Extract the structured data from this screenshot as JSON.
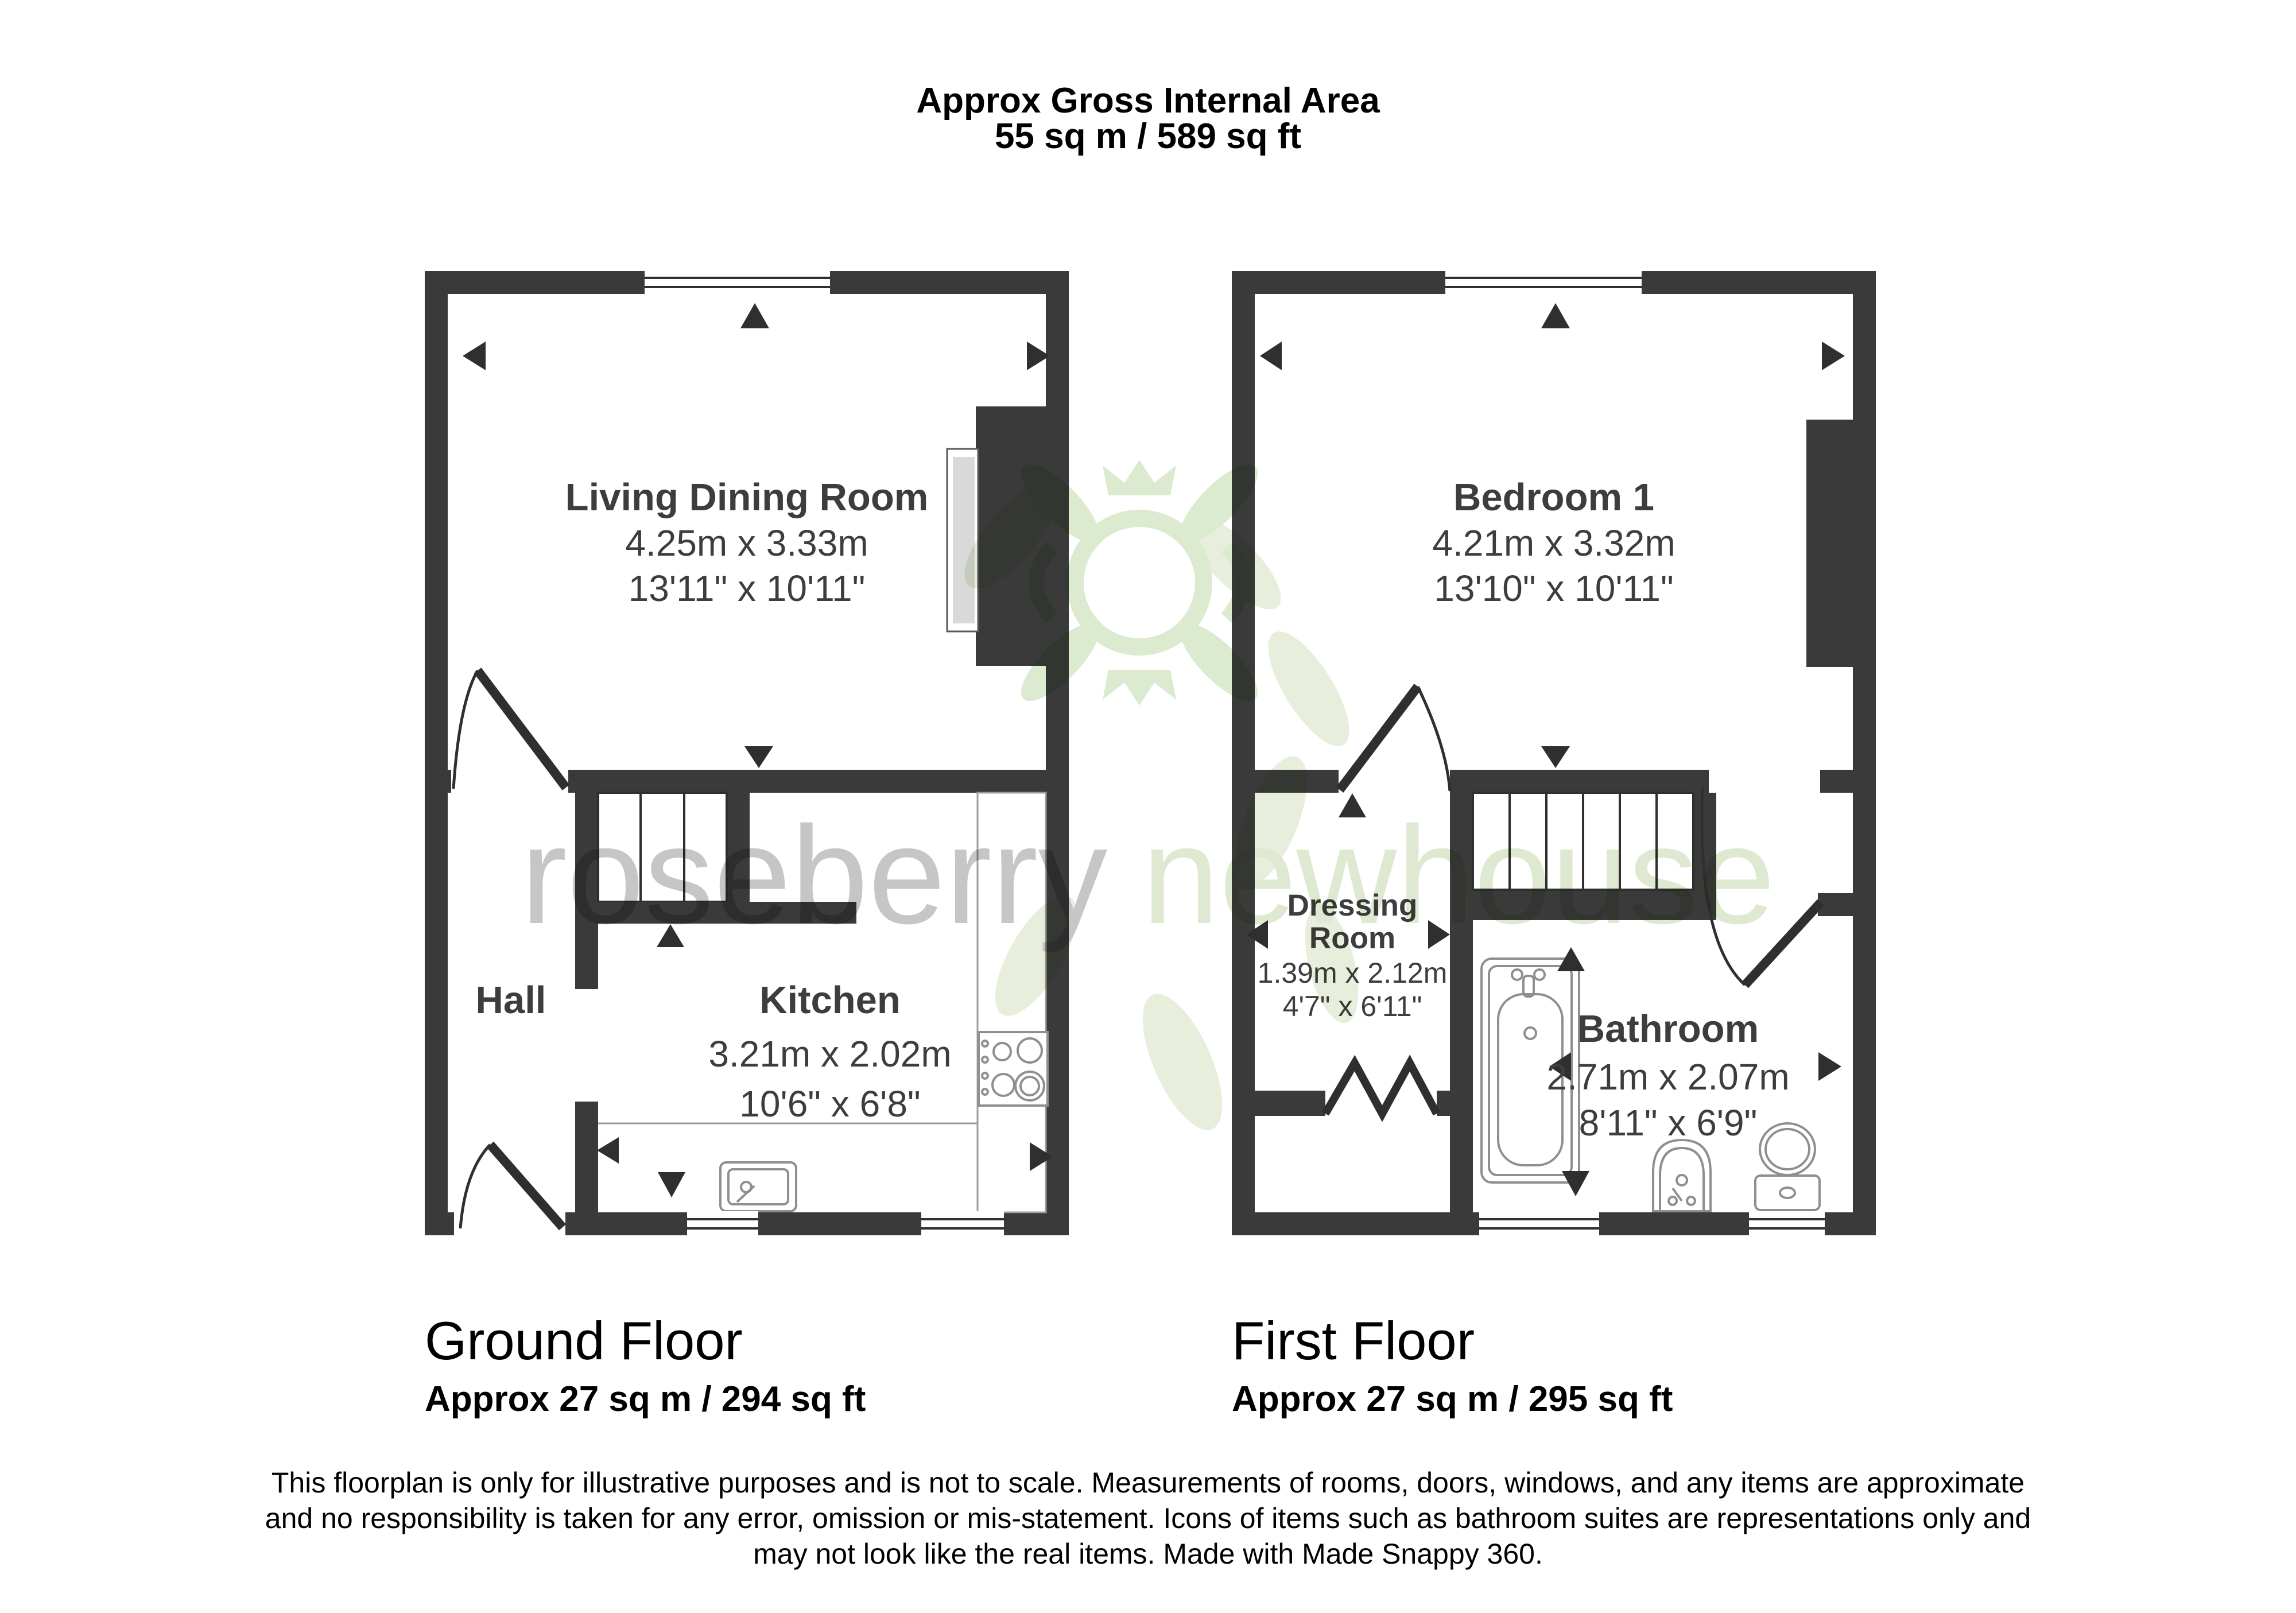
{
  "title": {
    "line1": "Approx Gross Internal Area",
    "line2": "55 sq m / 589 sq ft"
  },
  "ground_floor": {
    "caption": "Ground Floor",
    "area": "Approx 27 sq m / 294 sq ft",
    "living": {
      "name": "Living Dining Room",
      "metric": "4.25m x 3.33m",
      "imperial": "13'11\" x 10'11\""
    },
    "hall": {
      "name": "Hall"
    },
    "kitchen": {
      "name": "Kitchen",
      "metric": "3.21m x 2.02m",
      "imperial": "10'6\" x 6'8\""
    }
  },
  "first_floor": {
    "caption": "First Floor",
    "area": "Approx 27 sq m / 295 sq ft",
    "bedroom": {
      "name": "Bedroom 1",
      "metric": "4.21m x 3.32m",
      "imperial": "13'10\" x 10'11\""
    },
    "dressing": {
      "name_line1": "Dressing",
      "name_line2": "Room",
      "metric": "1.39m x 2.12m",
      "imperial": "4'7\" x 6'11\""
    },
    "bathroom": {
      "name": "Bathroom",
      "metric": "2.71m x 2.07m",
      "imperial": "8'11\" x 6'9\""
    }
  },
  "disclaimer": {
    "line1": "This floorplan is only for illustrative purposes and is not to scale. Measurements of rooms, doors, windows, and any items are approximate",
    "line2": "and no responsibility is taken for any error, omission or mis-statement. Icons of items such as bathroom suites are representations only and",
    "line3": "may not look like the real items. Made with Made Snappy 360."
  },
  "watermark": {
    "word1": "roseberry",
    "word2": "newhouse"
  },
  "colors": {
    "wall": "#3a3a3a",
    "room_label": "#3d3d3d",
    "watermark_gray": "#c6c6c6",
    "watermark_green": "#dfe9d2"
  }
}
